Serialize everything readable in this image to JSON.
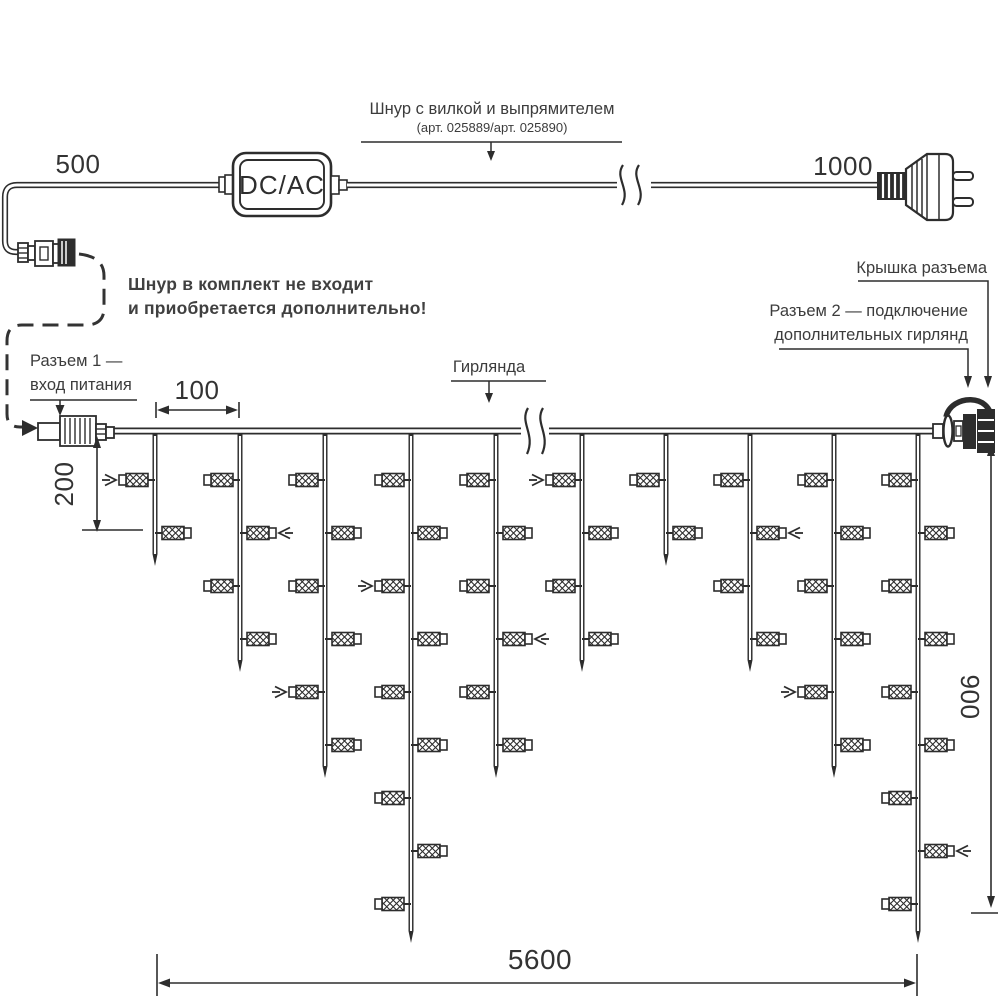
{
  "labels": {
    "power_cord_title": "Шнур с вилкой и выпрямителем",
    "power_cord_subtitle": "(арт. 025889/арт. 025890)",
    "converter": "DC/AC",
    "warning": [
      "Шнур в комплект не входит",
      "и приобретается дополнительно!"
    ],
    "connector1": [
      "Разъем 1 —",
      "вход питания"
    ],
    "garland": "Гирлянда",
    "cap": "Крышка разъема",
    "connector2": [
      "Разъем 2 — подключение",
      "дополнительных гирлянд"
    ]
  },
  "dimensions": {
    "dc_cord_length": "500",
    "plug_cord_length": "1000",
    "drop_spacing": "100",
    "first_drop_length": "200",
    "max_drop_length": "900",
    "garland_length": "5600"
  },
  "colors": {
    "line": "#2d2d2d",
    "text": "#3c3c3c",
    "background": "#ffffff"
  },
  "diagram": {
    "wire_y": 431,
    "bulb_row_start": 480,
    "bulb_row_step": 53,
    "drops": [
      {
        "x": 155,
        "bulbs": 2,
        "tip": 566,
        "marker_bulb": 0
      },
      {
        "x": 240,
        "bulbs": 4,
        "tip": 672,
        "marker_bulb": 1
      },
      {
        "x": 325,
        "bulbs": 6,
        "tip": 778,
        "marker_bulb": 4
      },
      {
        "x": 411,
        "bulbs": 9,
        "tip": 943,
        "marker_bulb": 2
      },
      {
        "x": 496,
        "bulbs": 6,
        "tip": 778,
        "marker_bulb": 3
      },
      {
        "x": 582,
        "bulbs": 4,
        "tip": 672,
        "marker_bulb": 0
      },
      {
        "x": 666,
        "bulbs": 2,
        "tip": 566,
        "marker_bulb": -1
      },
      {
        "x": 750,
        "bulbs": 4,
        "tip": 672,
        "marker_bulb": 1
      },
      {
        "x": 834,
        "bulbs": 6,
        "tip": 778,
        "marker_bulb": 4
      },
      {
        "x": 918,
        "bulbs": 9,
        "tip": 943,
        "marker_bulb": 7
      }
    ]
  }
}
